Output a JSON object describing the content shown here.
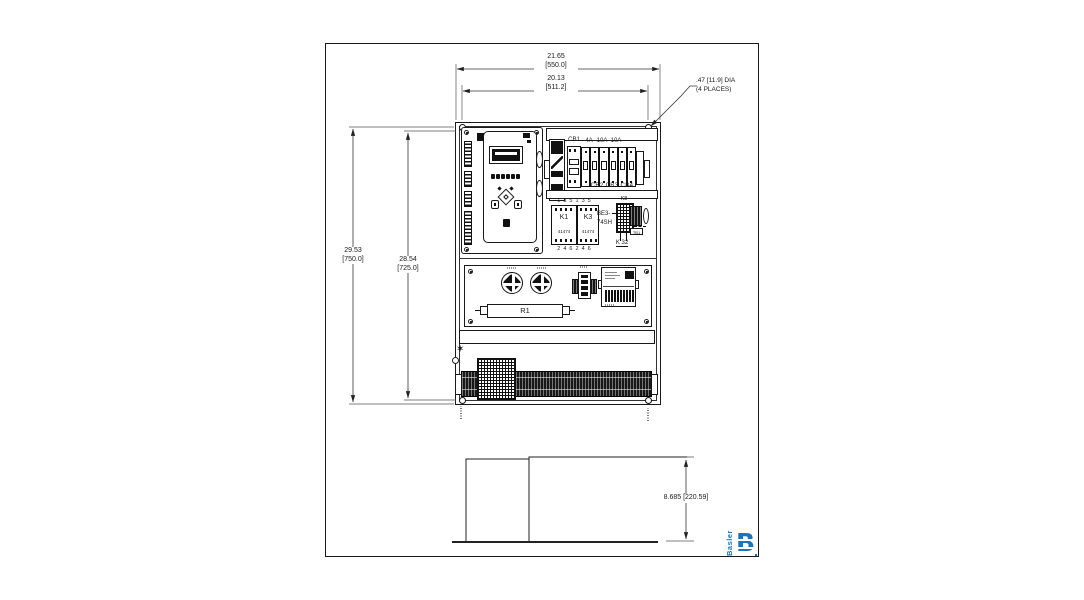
{
  "dims": {
    "top_outer_in": "21.65",
    "top_outer_mm": "[550.0]",
    "top_inner_in": "20.13",
    "top_inner_mm": "[511.2]",
    "left_outer_in": "29.53",
    "left_outer_mm": "[750.0]",
    "left_inner_in": "28.54",
    "left_inner_mm": "[725.0]",
    "depth": "8.685 [220.59]",
    "hole_note_1": ".47 [11.9] DIA",
    "hole_note_2": "(4 PLACES)"
  },
  "labels": {
    "cb1": "CB1",
    "rating_1": "4A",
    "rating_2": "10A",
    "rating_3": "10A",
    "cb_bottom": "CB2 CB3 CB4",
    "contact_top": "1 3 5 1 3 5",
    "contact_bottom": "2 4 6 2 4 6",
    "k1": "K1",
    "k1_part": "41474",
    "k3": "K3",
    "k3_part": "41474",
    "be3_1": "BE3-",
    "be3_2": "74SH",
    "k8": "K8",
    "k32": "K 32",
    "tb1": "TB1",
    "r1": "R1"
  },
  "icons": {
    "ground_star": "✶"
  },
  "logo": {
    "brand": "Basler",
    "letter": "B"
  },
  "colors": {
    "line": "#1a1a1a",
    "logo_blue": "#1b75bc",
    "background": "#ffffff"
  }
}
